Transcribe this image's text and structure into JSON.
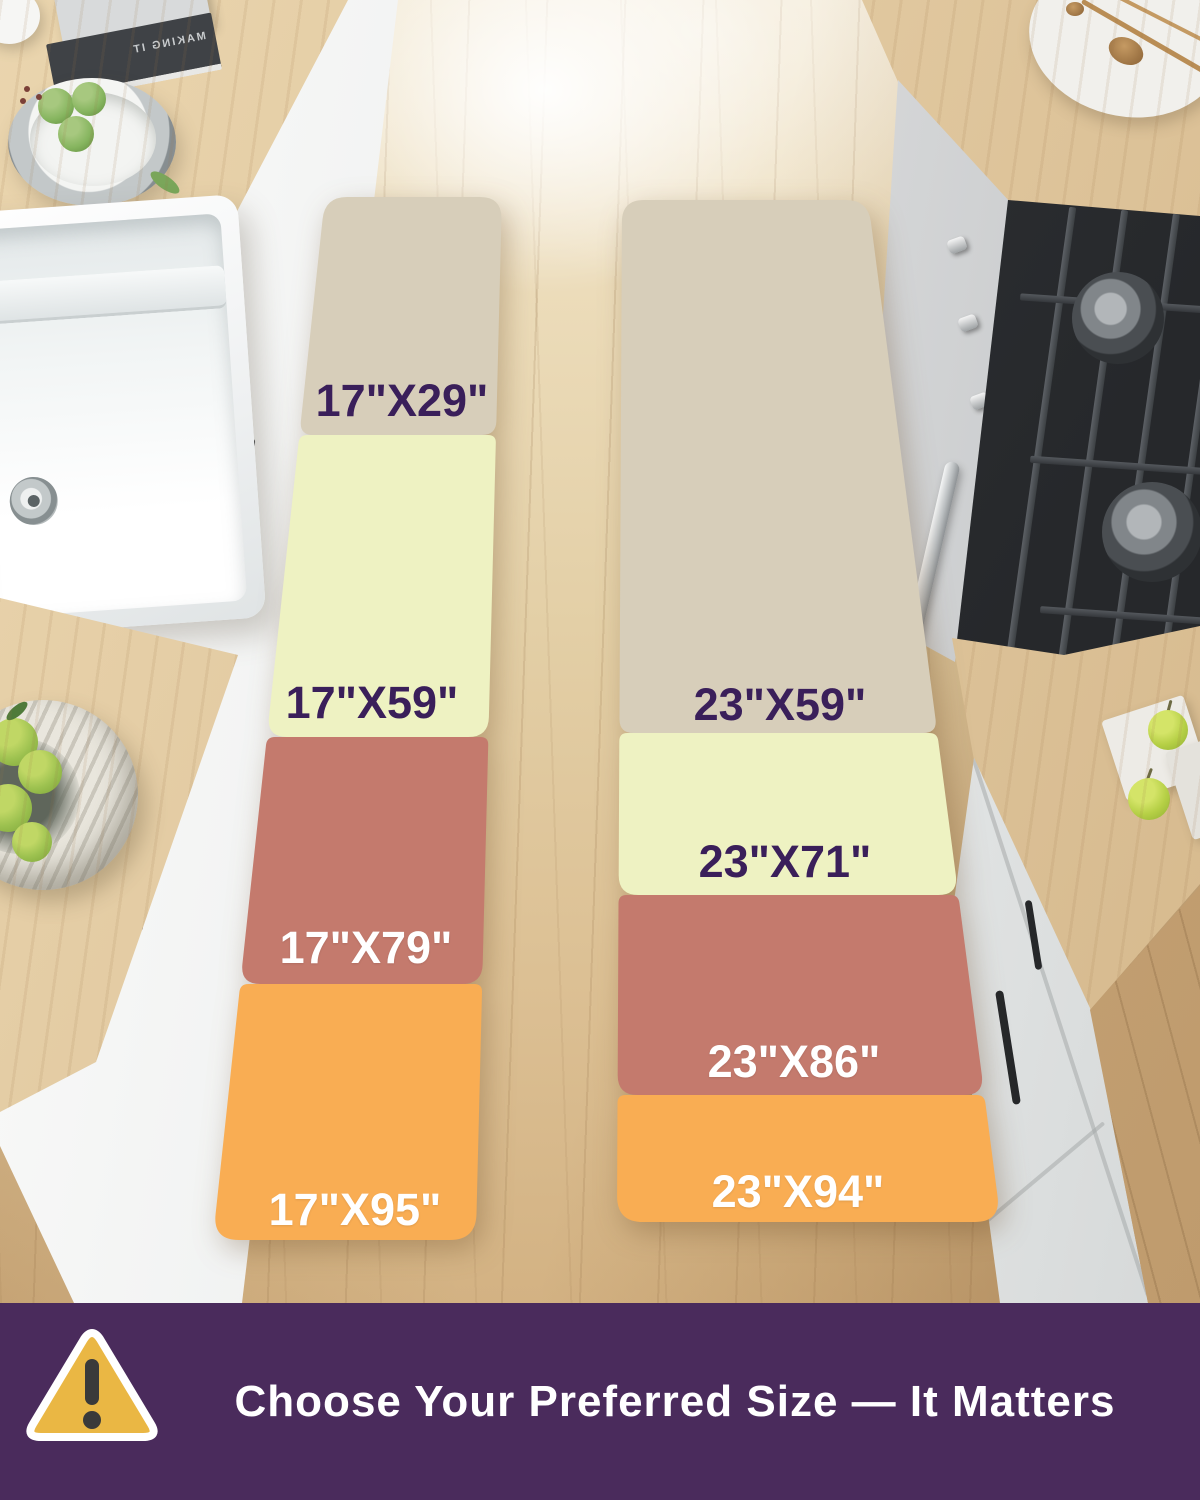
{
  "rugs": [
    {
      "name": "17 inch wide runner",
      "labels": [
        "17\"X29\"",
        "17\"X59\"",
        "17\"X79\"",
        "17\"X95\""
      ]
    },
    {
      "name": "23 inch wide runner",
      "labels": [
        "23\"X59\"",
        "23\"X71\"",
        "23\"X86\"",
        "23\"X94\""
      ]
    }
  ],
  "colors": {
    "beige": "#d7ceba",
    "yellow": "#eef2c2",
    "salmon": "#c47a6d",
    "orange": "#f9ad53",
    "banner_purple": "#4a2b5c",
    "label_purple": "#3a1f5a",
    "label_white": "#ffffff",
    "warning_yellow": "#eab744",
    "warning_mark": "#3a3a3a"
  },
  "banner": {
    "text": "Choose Your Preferred Size — It Matters"
  },
  "decor": {
    "book_title": "MAKING IT"
  }
}
